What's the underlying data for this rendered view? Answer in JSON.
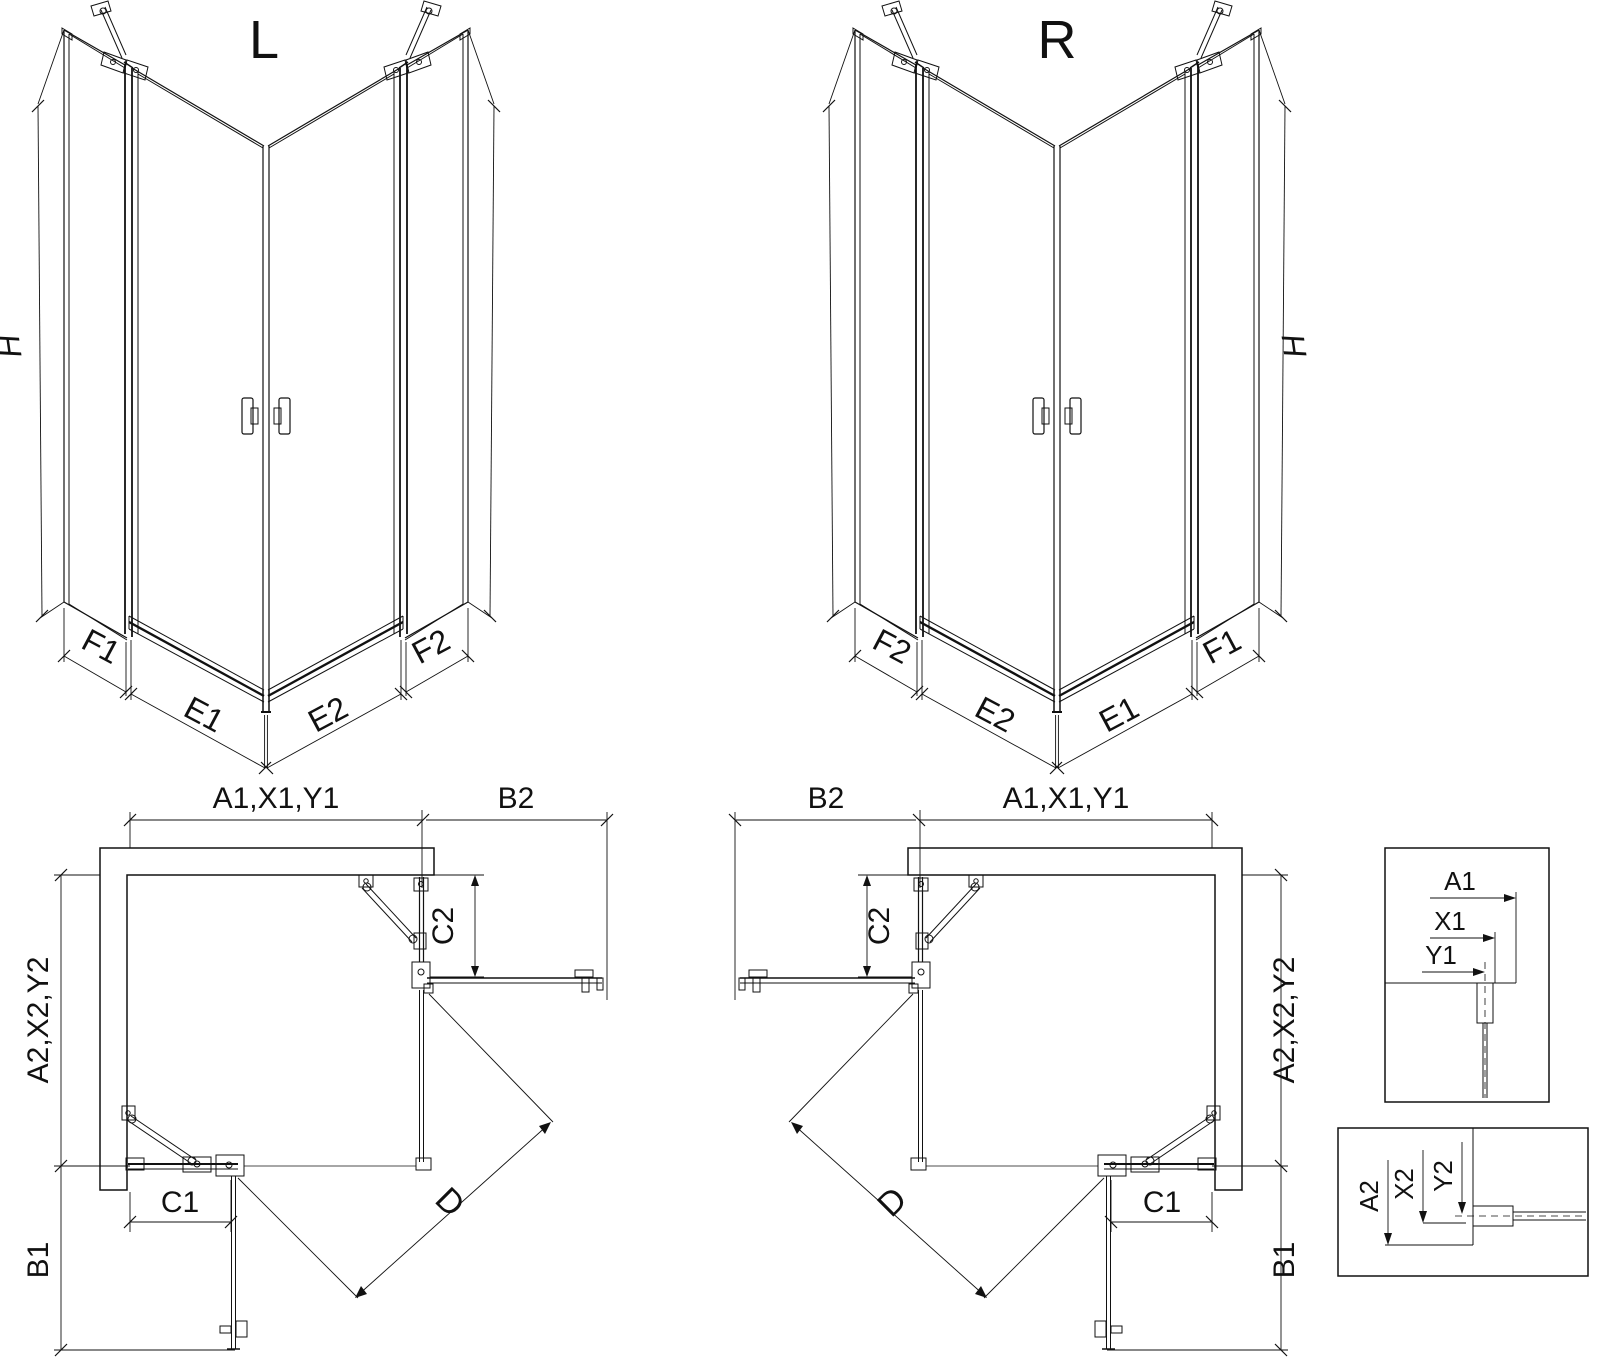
{
  "colors": {
    "background": "#ffffff",
    "line": "#111111"
  },
  "views": {
    "perspective_left": {
      "label": "L",
      "h": "H",
      "f1": "F1",
      "e1": "E1",
      "e2": "E2",
      "f2": "F2"
    },
    "perspective_right": {
      "label": "R",
      "h": "H",
      "f1": "F1",
      "e1": "E1",
      "e2": "E2",
      "f2": "F2"
    },
    "plan_left": {
      "width": "A1,X1,Y1",
      "panel": "B2",
      "fixed_right": "C2",
      "depth": "A2,X2,Y2",
      "fixed_bottom": "C1",
      "door_out": "B1",
      "diagonal": "D"
    },
    "plan_right": {
      "width": "A1,X1,Y1",
      "panel": "B2",
      "fixed_right": "C2",
      "depth": "A2,X2,Y2",
      "fixed_bottom": "C1",
      "door_out": "B1",
      "diagonal": "D"
    },
    "detail_width": {
      "a1": "A1",
      "x1": "X1",
      "y1": "Y1"
    },
    "detail_depth": {
      "a2": "A2",
      "x2": "X2",
      "y2": "Y2"
    }
  }
}
